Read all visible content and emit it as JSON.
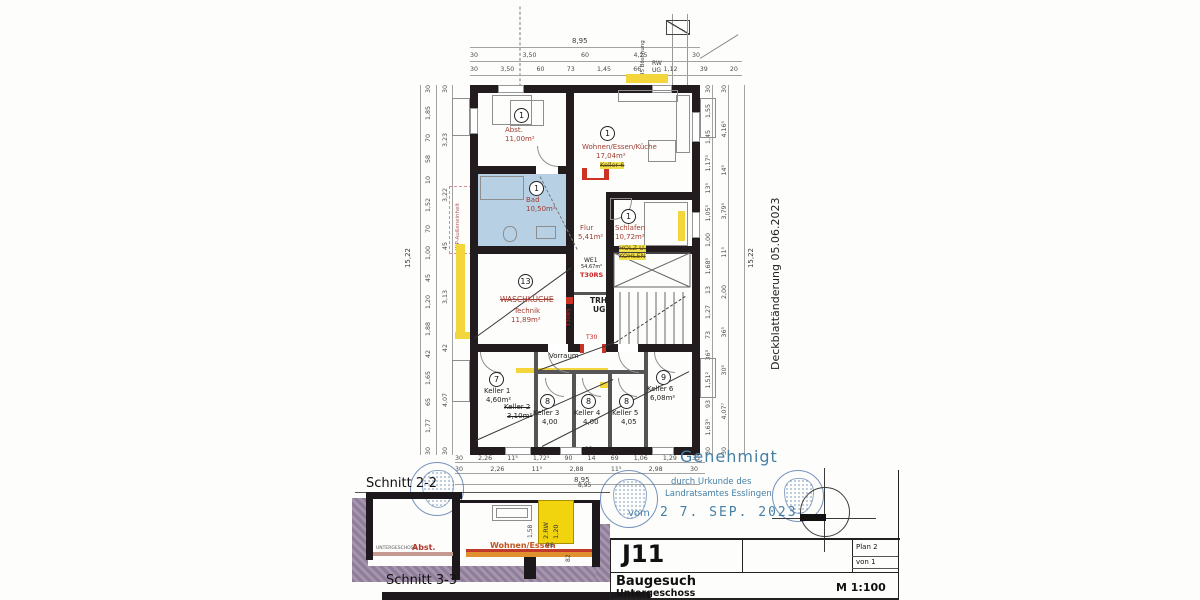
{
  "sidenote": "Deckblattänderung 05.06.2023",
  "approval": {
    "title": "Genehmigt",
    "line2": "durch Urkunde des",
    "line3": "Landratsamtes Esslingen",
    "vom": "vom",
    "date": "2 7. SEP. 2023"
  },
  "titleblock": {
    "code": "J11",
    "plan_no": "Plan  2",
    "von": "von  1",
    "project": "Baugesuch",
    "level": "Untergeschoss",
    "scale": "M 1:100"
  },
  "sections": {
    "s22": "Schnitt 2-2",
    "s33": "Schnitt 3-3",
    "total": "8,95",
    "floor": "UNTERGESCHOSS",
    "abst": "Abst.",
    "wohnen": "Wohnen/Essen",
    "rw_label": "2.RW",
    "rw_width": "1,20",
    "d96": "96",
    "d82": "82",
    "d158": "1,58"
  },
  "rooms": {
    "abst": {
      "num": "1",
      "name": "Abst.",
      "area": "11,00m²"
    },
    "wohnen": {
      "num": "1",
      "name": "Wohnen/Essen/Küche",
      "area": "17,04m²",
      "old": "Keller 6"
    },
    "bad": {
      "num": "1",
      "name": "Bad",
      "area": "10,50m²"
    },
    "flur": {
      "name": "Flur",
      "area": "5,41m²"
    },
    "schlafen": {
      "num": "1",
      "name": "Schlafen",
      "area": "10,72m²",
      "old1": "HOLZ U.",
      "old2": "KOHLEN"
    },
    "technik": {
      "num": "13",
      "old": "WASCHKÜCHE",
      "name": "Technik",
      "area": "11,89m²"
    },
    "we1": {
      "name": "WE1",
      "area": "54,67m²",
      "door": "T30RS"
    },
    "trh": {
      "l1": "TRH",
      "l2": "UG"
    },
    "vorraum": {
      "name": "Vorraum"
    },
    "keller1": {
      "num": "7",
      "name": "Keller 1",
      "area": "4,60m²"
    },
    "keller2": {
      "name": "Keller 2",
      "area": "3,10m²"
    },
    "keller3": {
      "num": "8",
      "name": "Keller 3",
      "area": "4,00"
    },
    "keller4": {
      "num": "8",
      "name": "Keller 4",
      "area": "4,00"
    },
    "keller5": {
      "num": "8",
      "name": "Keller 5",
      "area": "4,05"
    },
    "keller6": {
      "num": "9",
      "name": "Keller 6",
      "area": "6,08m²"
    }
  },
  "annotations": {
    "wp": "WP-Außeneinheit",
    "rw": "RW",
    "ug": "UG",
    "boeschung": "45 Böschung",
    "t30": "T30",
    "t30rs": "T30RS"
  },
  "dims": {
    "top_total": "8,95",
    "top_row1": [
      "30",
      "3,50",
      "60",
      "4,25",
      "30"
    ],
    "top_row2": [
      "30",
      "3,50",
      "60",
      "73",
      "1,45",
      "66",
      "1,12",
      "39",
      "20"
    ],
    "bottom_22": "22",
    "bottom_row1": [
      "30",
      "2,26",
      "11⁵",
      "1,72⁵",
      "90",
      "14",
      "69",
      "1,06",
      "1,29",
      "35"
    ],
    "bottom_row2": [
      "30",
      "2,26",
      "11⁵",
      "2,88",
      "11⁵",
      "2,98",
      "30"
    ],
    "bottom_total": "8,95",
    "left_total": "15,22",
    "left_outer": [
      "30",
      "1,85",
      "70",
      "58",
      "10",
      "1,52",
      "70",
      "1,00",
      "45",
      "1,20",
      "1,88",
      "42",
      "1,65",
      "65",
      "1,77",
      "30"
    ],
    "left_inner": [
      "30",
      "3,23",
      "3,22",
      "45",
      "3,13",
      "42",
      "4,07",
      "30"
    ],
    "right_total": "15,22",
    "right_outer": [
      "30",
      "1,55",
      "1,45",
      "1,17⁵",
      "13⁵",
      "1,05⁵",
      "1,00",
      "1,68⁵",
      "13",
      "1,27",
      "73",
      "36³",
      "1,51²",
      "93",
      "1,63⁵",
      "30"
    ],
    "right_inner": [
      "30",
      "4,16⁵",
      "14⁵",
      "3,79⁵",
      "11⁵",
      "2,00",
      "36⁵",
      "30⁵",
      "4,07⁷",
      "30"
    ]
  }
}
